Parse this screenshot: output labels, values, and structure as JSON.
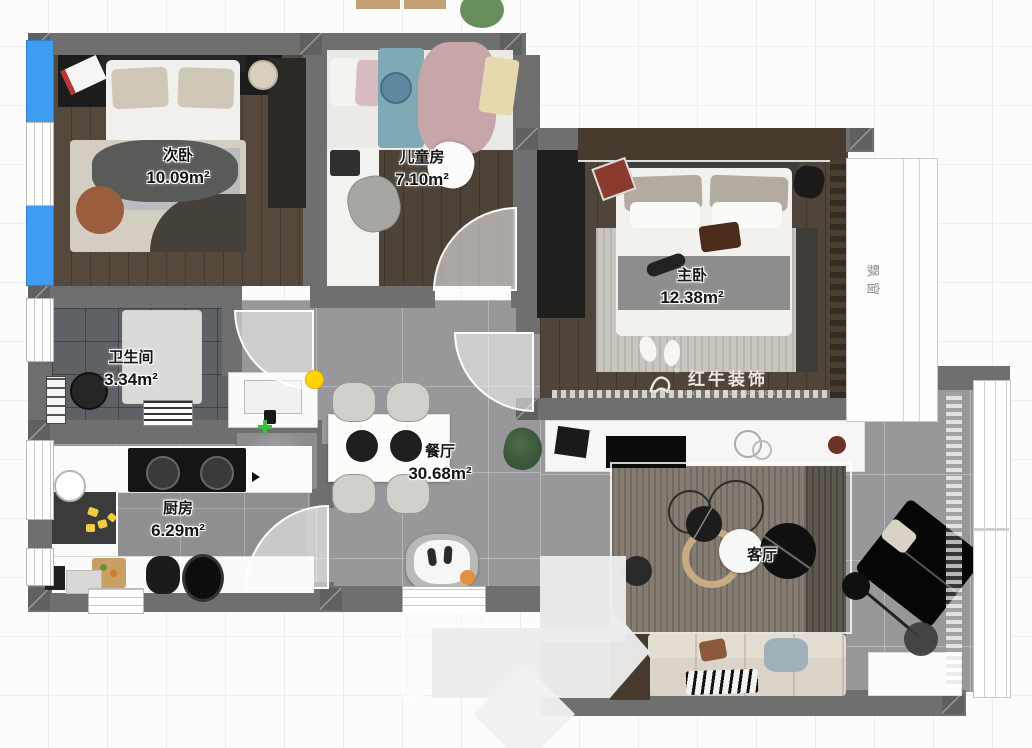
{
  "plan": {
    "rooms": [
      {
        "name": "次卧",
        "area": "10.09m²"
      },
      {
        "name": "儿童房",
        "area": "7.10m²"
      },
      {
        "name": "主卧",
        "area": "12.38m²"
      },
      {
        "name": "卫生间",
        "area": "3.34m²"
      },
      {
        "name": "厨房",
        "area": "6.29m²"
      },
      {
        "name": "餐厅",
        "area": "30.68m²"
      },
      {
        "name": "客厅",
        "area": ""
      }
    ],
    "bay_window_label": "飘窗",
    "watermark": {
      "brand": "红牛装饰",
      "registered": "®",
      "subtitle": "HONG NIU DECORATION"
    }
  },
  "colors": {
    "wall": "#6f6f6f",
    "winblue": "#3e9cf2",
    "yellow": "#ffd400",
    "green": "#3cbf44",
    "orange": "#e2903f",
    "brand": "#f2efe8"
  }
}
